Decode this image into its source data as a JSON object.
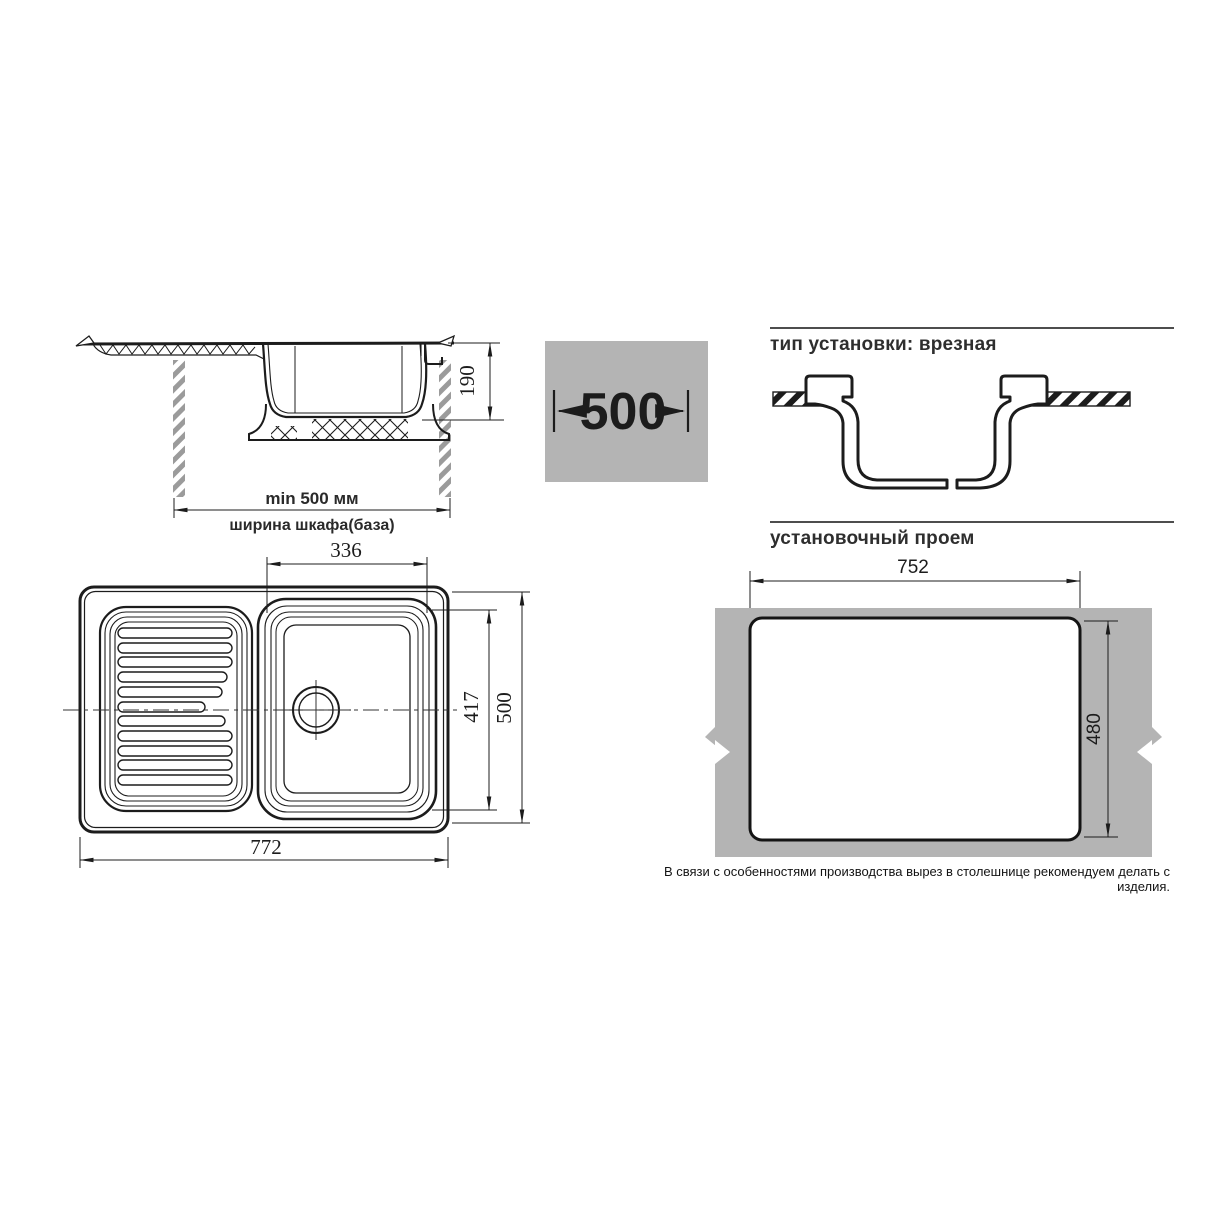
{
  "colors": {
    "line": "#1c1c1c",
    "gray_fill": "#b4b4b4",
    "hatch_gray": "#9b9b9b",
    "rule": "#4d4d4d"
  },
  "side_view": {
    "depth_dim": "190",
    "min_width_label": "min 500 мм",
    "cabinet_width_label": "ширина шкафа(база)"
  },
  "cabinet_badge": {
    "width_dim": "500"
  },
  "install_type": {
    "heading": "тип установки: врезная"
  },
  "cutout": {
    "heading": "установочный проем",
    "width_dim": "752",
    "height_dim": "480",
    "note": "В связи с особенностями производства вырез в столешнице рекомендуем делать с изделия."
  },
  "top_view": {
    "bowl_width_dim": "336",
    "bowl_depth_dim": "417",
    "sink_depth_dim": "500",
    "sink_width_dim": "772"
  }
}
